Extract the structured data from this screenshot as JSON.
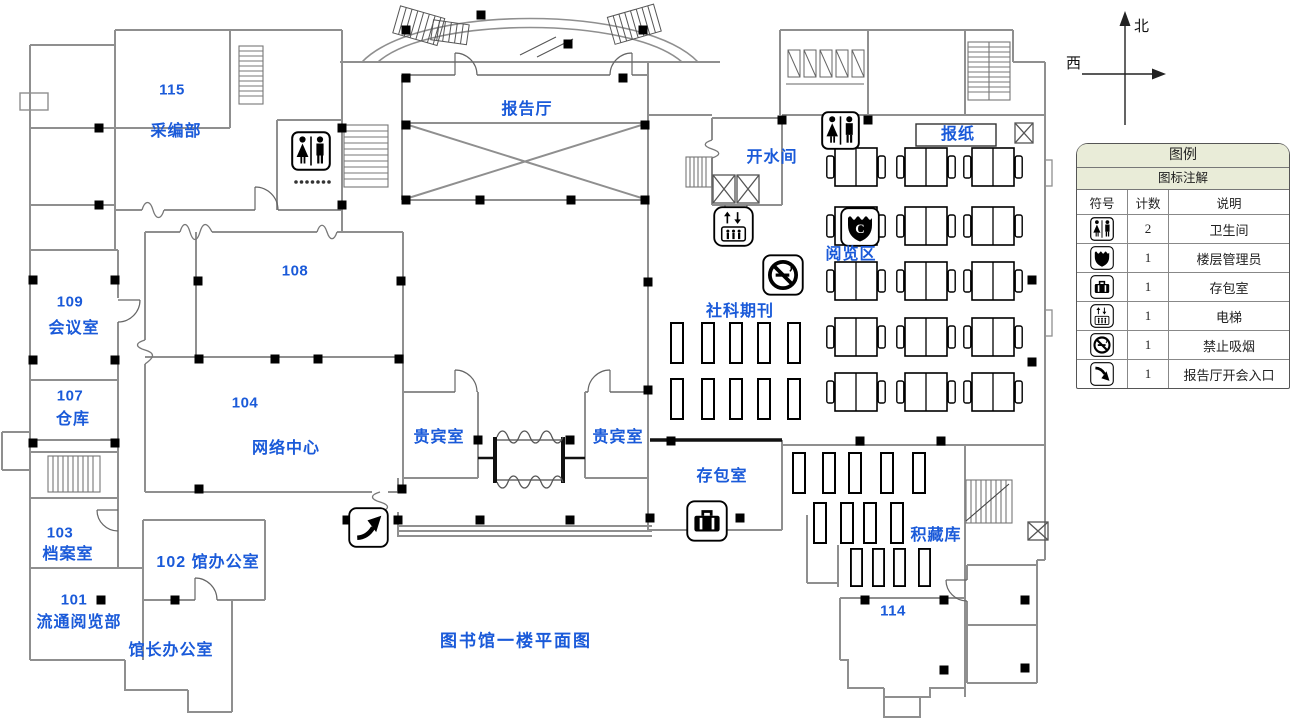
{
  "plan": {
    "labels": [
      {
        "id": "room-115-number",
        "text": "115"
      },
      {
        "id": "room-115-name",
        "text": "采编部"
      },
      {
        "id": "lecture-hall",
        "text": "报告厅"
      },
      {
        "id": "hot-water-room",
        "text": "开水间"
      },
      {
        "id": "newspaper-rack",
        "text": "报纸"
      },
      {
        "id": "reading-area",
        "text": "阅览区"
      },
      {
        "id": "room-108-number",
        "text": "108"
      },
      {
        "id": "room-109-number",
        "text": "109"
      },
      {
        "id": "room-109-name",
        "text": "会议室"
      },
      {
        "id": "social-science-periodicals",
        "text": "社科期刊"
      },
      {
        "id": "room-107-number",
        "text": "107"
      },
      {
        "id": "room-107-name",
        "text": "仓库"
      },
      {
        "id": "room-104-number",
        "text": "104"
      },
      {
        "id": "room-104-name",
        "text": "网络中心"
      },
      {
        "id": "vip-room-left",
        "text": "贵宾室"
      },
      {
        "id": "vip-room-right",
        "text": "贵宾室"
      },
      {
        "id": "bag-storage-room",
        "text": "存包室"
      },
      {
        "id": "stack-room",
        "text": "积藏库"
      },
      {
        "id": "room-103-number",
        "text": "103"
      },
      {
        "id": "room-103-name",
        "text": "档案室"
      },
      {
        "id": "room-102",
        "text": "102 馆办公室"
      },
      {
        "id": "room-101-number",
        "text": "101"
      },
      {
        "id": "room-101-name",
        "text": "流通阅览部"
      },
      {
        "id": "director-office",
        "text": "馆长办公室"
      },
      {
        "id": "room-114-number",
        "text": "114"
      },
      {
        "id": "plan-title",
        "text": "图书馆一楼平面图"
      }
    ],
    "shield_letter": "C"
  },
  "compass": {
    "north": "北",
    "west": "西"
  },
  "legend": {
    "title": "图例",
    "subtitle": "图标注解",
    "columns": [
      "符号",
      "计数",
      "说明"
    ],
    "rows": [
      {
        "icon": "restroom-icon",
        "count": "2",
        "desc": "卫生间"
      },
      {
        "icon": "floor-manager-icon",
        "count": "1",
        "desc": "楼层管理员"
      },
      {
        "icon": "bag-storage-icon",
        "count": "1",
        "desc": "存包室"
      },
      {
        "icon": "elevator-icon",
        "count": "1",
        "desc": "电梯"
      },
      {
        "icon": "no-smoking-icon",
        "count": "1",
        "desc": "禁止吸烟"
      },
      {
        "icon": "lecture-hall-entrance-icon",
        "count": "1",
        "desc": "报告厅开会入口"
      }
    ]
  }
}
